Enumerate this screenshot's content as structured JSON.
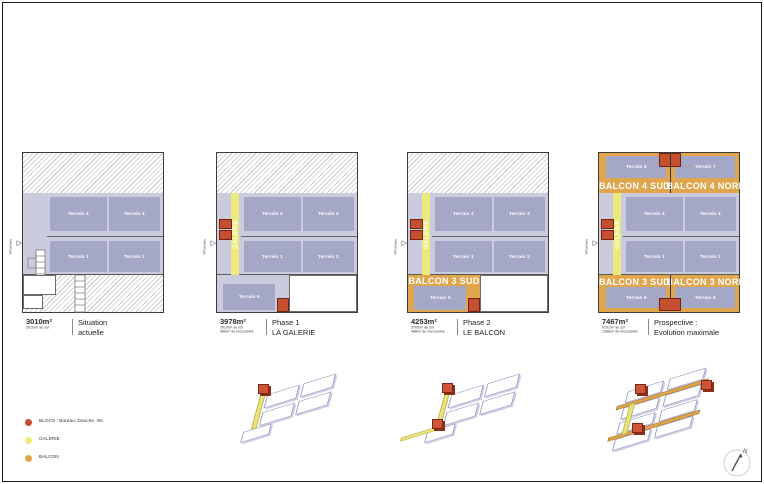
{
  "terrain_labels": {
    "t1": "Terrain 1",
    "t2": "Terrain 2",
    "t3": "Terrain 3",
    "t4": "Terrain 4",
    "t5": "Terrain 5",
    "t6": "Terrain 6",
    "t7": "Terrain 7",
    "t8": "Terrain 8"
  },
  "galerie_label": "GALERIE",
  "balcon_labels": {
    "b3s": "BALCON 3 SUD",
    "b3n": "BALCON 3 NORD",
    "b4s": "BALCON 4 SUD",
    "b4n": "BALCON 4 NORD"
  },
  "plans": [
    {
      "area": "3010m²",
      "detail1": "3010m² au sol",
      "detail2": "",
      "title1": "Situation",
      "title2": "actuelle"
    },
    {
      "area": "3978m²",
      "detail1": "3010m² au sol",
      "detail2": "968m² de mezzanine",
      "title1": "Phase 1",
      "title2": "LA GALERIE"
    },
    {
      "area": "4253m²",
      "detail1": "3765m² au sol",
      "detail2": "488m² de mezzanine",
      "title1": "Phase 2",
      "title2": "LE BALCON"
    },
    {
      "area": "7467m²",
      "detail1": "6101m² au sol",
      "detail2": "1366m² de mezzanine",
      "title1": "Prospective :",
      "title2": "Evolution maximale"
    }
  ],
  "entrance_marker": {
    "label": "TOPTEN Entrée"
  },
  "legend": {
    "items": [
      {
        "label": "BLOCS : Bureau, Douche, Wc",
        "color": "#c5502f"
      },
      {
        "label": "GALERIE",
        "color": "#ece97d"
      },
      {
        "label": "BALCON",
        "color": "#dfa64e"
      }
    ]
  },
  "north_label": "N",
  "colors": {
    "hall_bg": "#cacbdc",
    "terrain": "#a5a7c6",
    "galerie": "#ece97d",
    "balcon": "#dfa64e",
    "blocs": "#c5502f",
    "wireframe": "#9495c4"
  }
}
